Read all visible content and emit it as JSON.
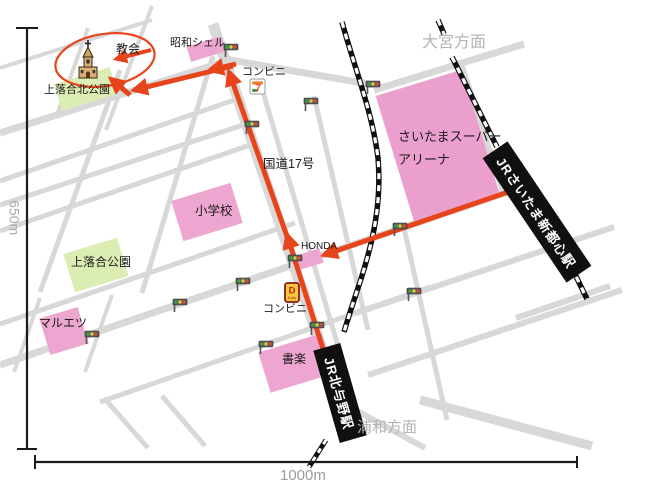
{
  "map": {
    "destination": {
      "label": "教会",
      "icon": "church-icon",
      "highlight_color": "#e8441c"
    },
    "direction_labels": {
      "top_right": "大宮方面",
      "bottom": "浦和方面"
    },
    "stations": {
      "shintoshin": "JRさいたま新都心駅",
      "kitayono": "JR北与野駅"
    },
    "places": {
      "showa_shell": "昭和シェル",
      "convenience_top": "コンビニ",
      "convenience_bottom": "コンビニ",
      "park_north": "上落合北公園",
      "arena_line1": "さいたまスーパー",
      "arena_line2": "アリーナ",
      "route17": "国道17号",
      "school": "小学校",
      "honda": "HONDA",
      "park": "上落合公園",
      "maruetsu": "マルエツ",
      "bookstore": "書楽"
    },
    "scale": {
      "vertical": "650m",
      "horizontal": "1000m"
    },
    "icon_text": {
      "seven": "7",
      "daily_d": "D",
      "daily_word": "Daily"
    },
    "icons": [
      "church-icon",
      "seven-eleven-icon",
      "daily-yamazaki-icon",
      "traffic-light-icon",
      "railway-track",
      "red-route-arrow",
      "red-ellipse-highlight"
    ],
    "traffic_light_count": 12,
    "colors": {
      "route_red": "#e8441c",
      "block_pink": "#eda6d0",
      "park_green": "#dcedb4",
      "road_gray": "#d8d8d8",
      "railway_black": "#101010",
      "muted_text": "#b3b3b3"
    }
  }
}
